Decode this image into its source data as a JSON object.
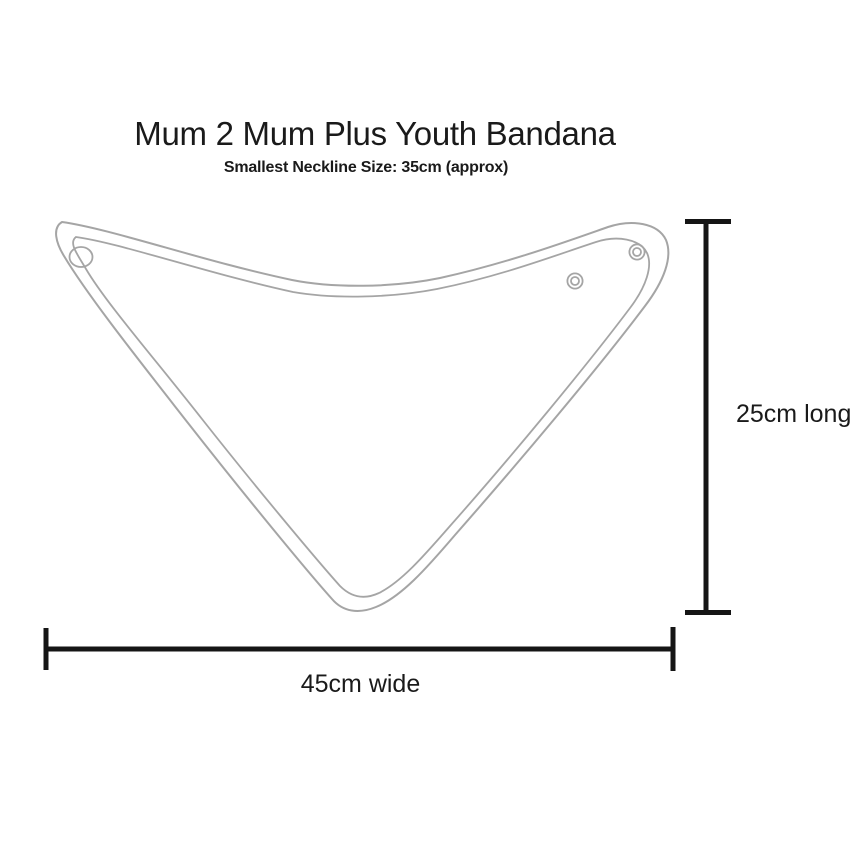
{
  "title": "Mum 2 Mum Plus Youth Bandana",
  "subtitle": "Smallest Neckline Size: 35cm (approx)",
  "dimensions": {
    "width_label": "45cm wide",
    "length_label": "25cm long"
  },
  "colors": {
    "outline": "#a5a5a5",
    "dimension_line": "#151515",
    "text": "#1a1a1a",
    "background": "#ffffff"
  }
}
